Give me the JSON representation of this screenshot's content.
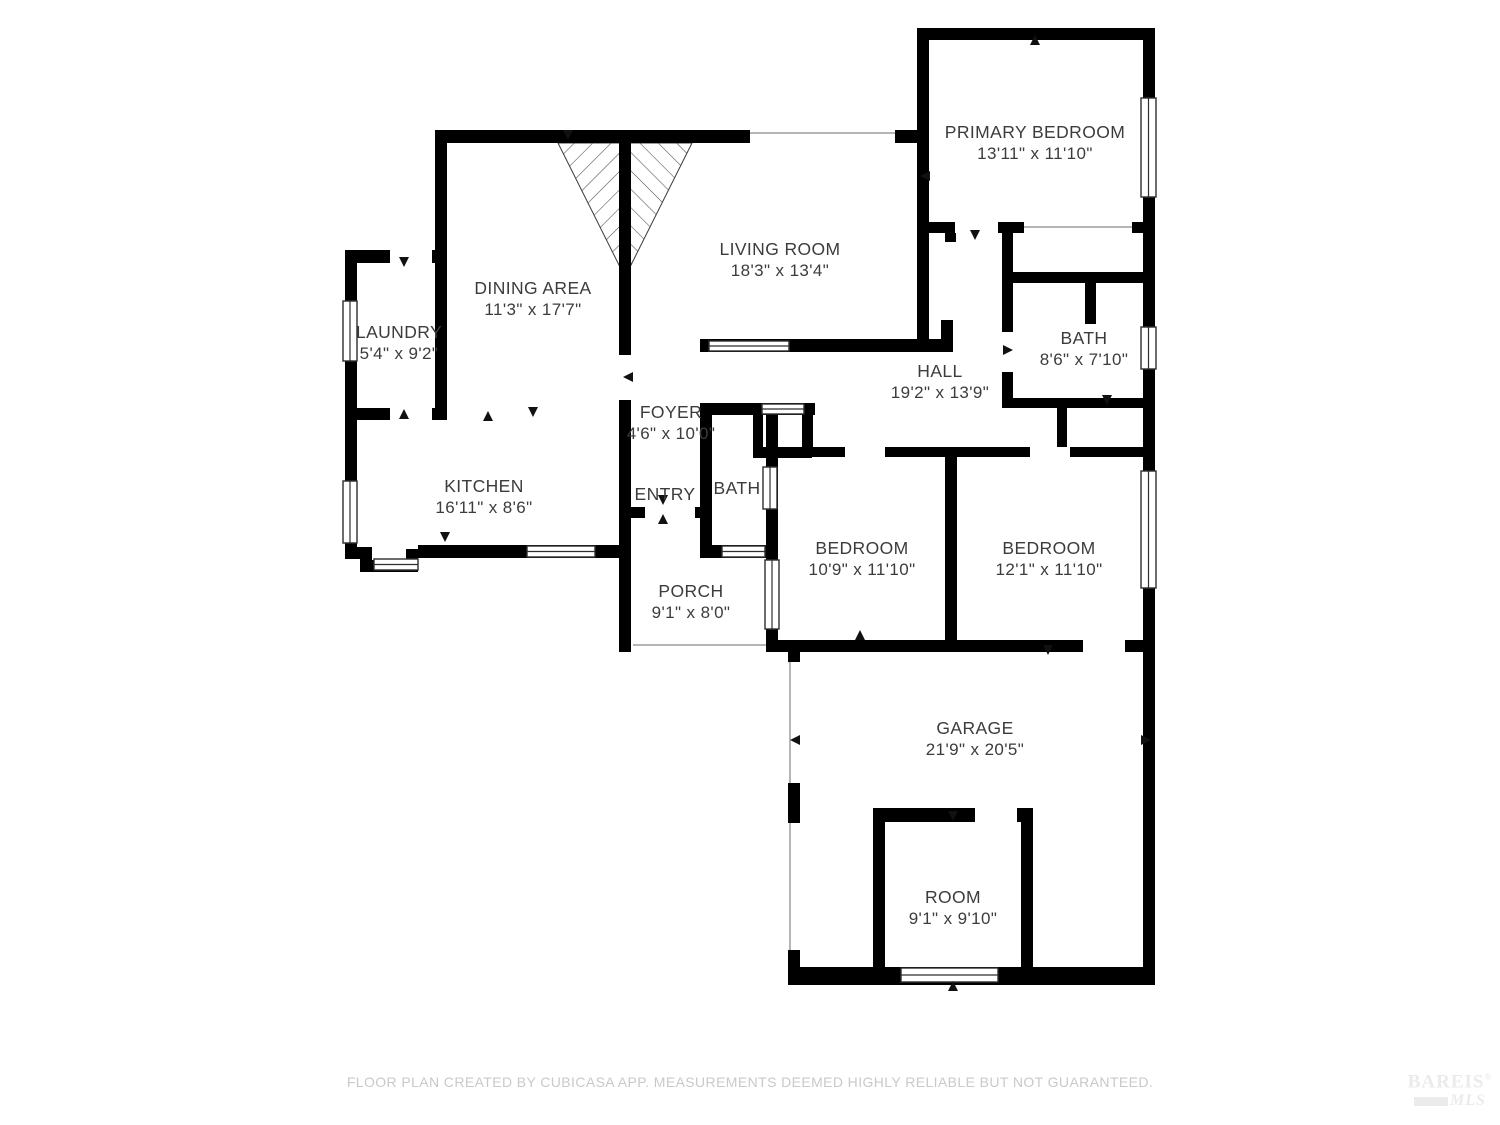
{
  "meta": {
    "footer": "FLOOR PLAN CREATED BY CUBICASA APP. MEASUREMENTS DEEMED HIGHLY RELIABLE BUT NOT GUARANTEED.",
    "logo_line1": "BAREIS",
    "logo_registered": "®",
    "logo_line2": "MLS"
  },
  "colors": {
    "wall": "#000000",
    "label": "#3c3c3c",
    "footer": "#c9c9c9",
    "thin_line": "#b5b5b5",
    "logo": "#ebebeb"
  },
  "rooms": [
    {
      "id": "primary-bedroom",
      "name": "PRIMARY BEDROOM",
      "dims": "13'11\" x 11'10\""
    },
    {
      "id": "living-room",
      "name": "LIVING ROOM",
      "dims": "18'3\" x 13'4\""
    },
    {
      "id": "dining-area",
      "name": "DINING AREA",
      "dims": "11'3\" x 17'7\""
    },
    {
      "id": "laundry",
      "name": "LAUNDRY",
      "dims": "5'4\" x 9'2\""
    },
    {
      "id": "kitchen",
      "name": "KITCHEN",
      "dims": "16'11\" x 8'6\""
    },
    {
      "id": "foyer",
      "name": "FOYER",
      "dims": "4'6\" x 10'0\""
    },
    {
      "id": "entry",
      "name": "ENTRY",
      "dims": ""
    },
    {
      "id": "bath-center",
      "name": "BATH",
      "dims": ""
    },
    {
      "id": "hall",
      "name": "HALL",
      "dims": "19'2\" x 13'9\""
    },
    {
      "id": "bath-right",
      "name": "BATH",
      "dims": "8'6\" x 7'10\""
    },
    {
      "id": "bedroom-1",
      "name": "BEDROOM",
      "dims": "10'9\" x 11'10\""
    },
    {
      "id": "bedroom-2",
      "name": "BEDROOM",
      "dims": "12'1\" x 11'10\""
    },
    {
      "id": "porch",
      "name": "PORCH",
      "dims": "9'1\" x 8'0\""
    },
    {
      "id": "garage",
      "name": "GARAGE",
      "dims": "21'9\" x 20'5\""
    },
    {
      "id": "room",
      "name": "ROOM",
      "dims": "9'1\" x 9'10\""
    }
  ]
}
